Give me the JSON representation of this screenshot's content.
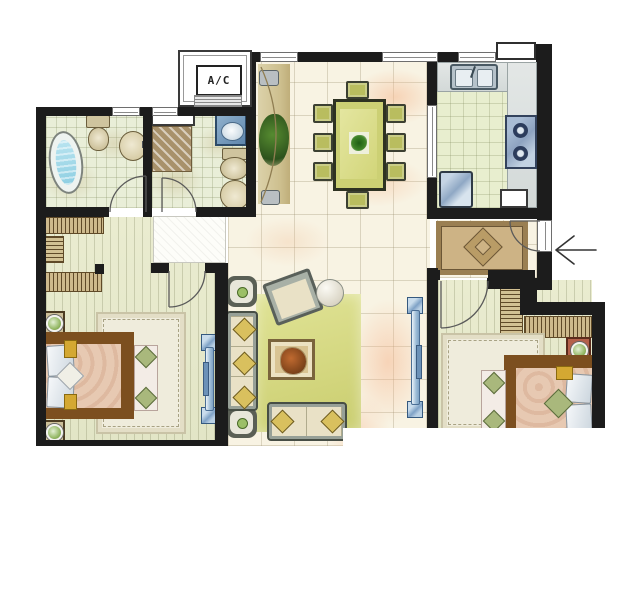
{
  "labels": {
    "ac_unit": "A/C"
  },
  "icons": {
    "entry_arrow": "arrow-left-icon"
  },
  "palette": {
    "wall": "#1c1c1c",
    "tile_floor": "#f8f3e3",
    "plank_floor": "#e8eacd",
    "bath_tile": "#e9eed8",
    "kitchen_tile": "#e8eecf",
    "living_rug": "#d2d57e",
    "entry_rug": "#cdb385",
    "dining_table": "#ccd074",
    "bed_frame": "#7c4f1f",
    "bed_duvet": "#e7c9b2",
    "bath_water": "#9fd8e8",
    "glass_blue": "#8fb2d2",
    "pillow_gold": "#d4a832",
    "lamp_green": "#8fb45e",
    "marble_vein": "#f3bc96"
  }
}
